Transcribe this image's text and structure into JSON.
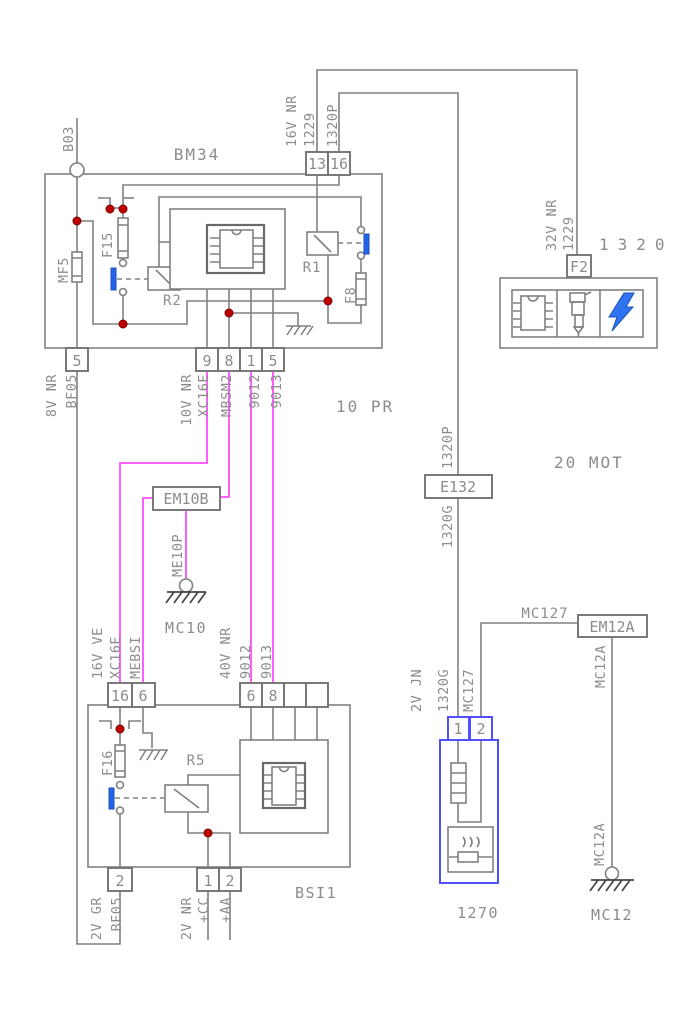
{
  "colors": {
    "wire_gray": "#808080",
    "label_gray": "#8c8c8c",
    "wire_magenta": "#ff4dff",
    "contact_blue": "#2265e8",
    "component_blue": "#5050ff",
    "bolt_blue": "#2f74f0",
    "junction_red": "#c00000"
  },
  "zones": {
    "pr": "10 PR",
    "mot": "20 MOT"
  },
  "b03": {
    "ref": "B03"
  },
  "bm34": {
    "title": "BM34",
    "pin13": "13",
    "pin16": "16",
    "lbl_16v_nr": "16V NR",
    "lbl_1229": "1229",
    "lbl_1320p": "1320P",
    "mf5": "MF5",
    "f15": "F15",
    "f8": "F8",
    "r1": "R1",
    "r2": "R2",
    "pin5_left": "5",
    "lbl_8v_nr": "8V NR",
    "lbl_bf05": "BF05",
    "pin9": "9",
    "pin8": "8",
    "pin1": "1",
    "pin5": "5",
    "lbl_10v_nr": "10V NR",
    "lbl_xc16e": "XC16E",
    "lbl_mbsm2": "MBSM2",
    "lbl_9012": "9012",
    "lbl_9013": "9013"
  },
  "unit1320": {
    "title": "1320",
    "fuse": "F2",
    "lbl_32v_nr": "32V NR",
    "lbl_1229": "1229"
  },
  "e132": {
    "ref": "E132",
    "lbl_up": "1320P",
    "lbl_down": "1320G"
  },
  "em10b": {
    "ref": "EM10B",
    "lbl_me10p": "ME10P",
    "ground": "MC10"
  },
  "bsi1": {
    "title": "BSI1",
    "pin16": "16",
    "pin6": "6",
    "lbl_16v_ve": "16V VE",
    "lbl_xc16e": "XC16E",
    "lbl_mebsi": "MEBSI",
    "lbl_40v_nr": "40V NR",
    "lbl_9012": "9012",
    "lbl_9013": "9013",
    "pin6b": "6",
    "pin8": "8",
    "f16": "F16",
    "r5": "R5",
    "pin2": "2",
    "lbl_2v_gr": "2V GR",
    "lbl_bf05": "BF05",
    "pin1": "1",
    "pin2b": "2",
    "lbl_2v_nr": "2V NR",
    "lbl_cc": "+CC",
    "lbl_aa": "+AA"
  },
  "unit1270": {
    "ref": "1270",
    "pin1": "1",
    "pin2": "2",
    "lbl_2v_jn": "2V JN",
    "lbl_1320g": "1320G",
    "lbl_mc127": "MC127",
    "mc127_wire": "MC127",
    "em12a": "EM12A",
    "lbl_mc12a": "MC12A",
    "ground": "MC12"
  }
}
